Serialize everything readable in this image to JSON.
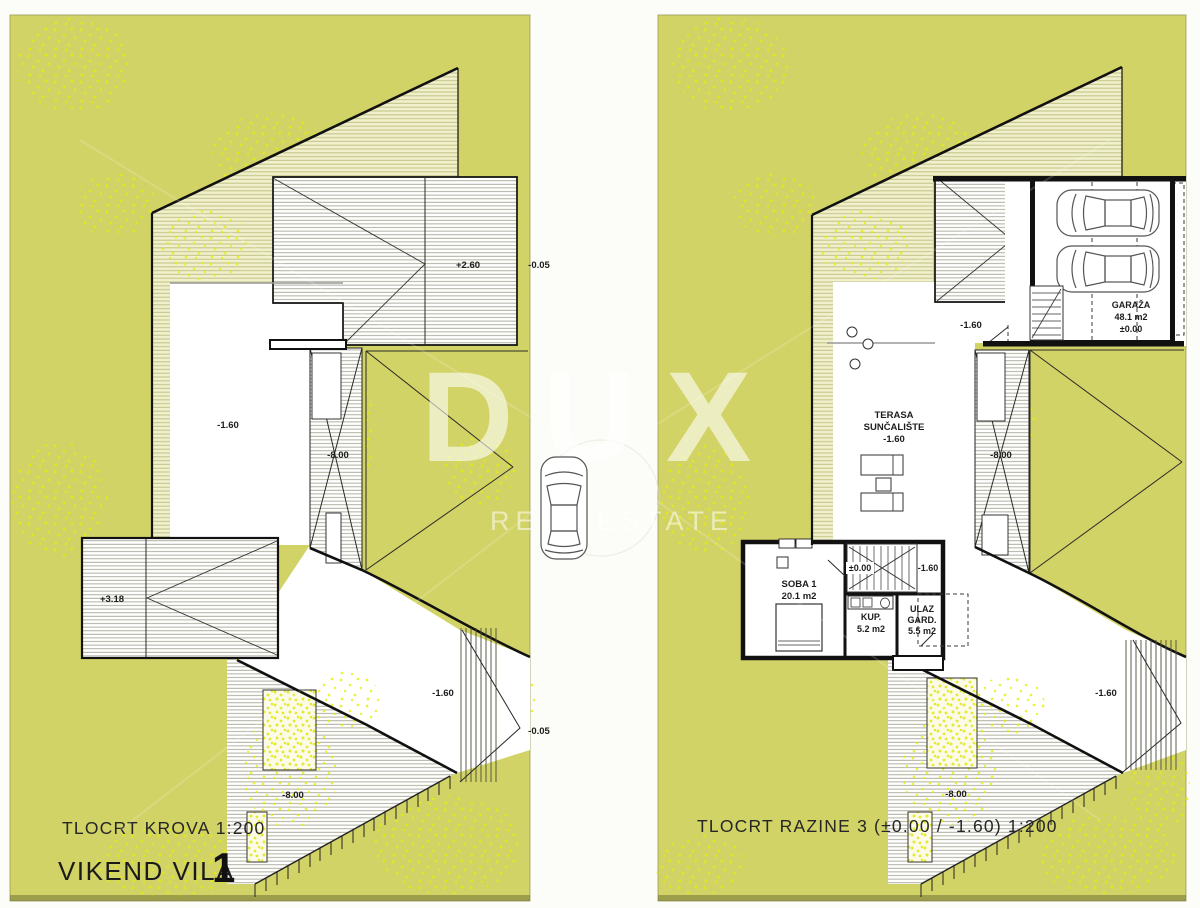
{
  "watermark": {
    "brand": "DUX",
    "tagline": "REAL ESTATE"
  },
  "left_plan": {
    "caption": "TLOCRT KROVA 1:200",
    "project_title": "VIKEND VILA",
    "project_number": "1",
    "levels": {
      "roof_main": "+2.60",
      "plot_ne": "-0.05",
      "terrace": "-1.60",
      "lightwell": "-8.00",
      "roof_lower": "+3.18",
      "driveway": "-1.60",
      "plot_se": "-0.05",
      "slope": "-8.00"
    }
  },
  "right_plan": {
    "caption": "TLOCRT RAZINE 3 (±0.00 / -1.60) 1:200",
    "levels": {
      "outside_garage": "-1.60",
      "lightwell": "-8.00",
      "stair_upper": "±0.00",
      "stair_lower": "-1.60",
      "driveway": "-1.60",
      "slope": "-8.00"
    },
    "rooms": {
      "garage": {
        "name": "GARAŽA",
        "area": "48.1 m2",
        "level": "±0.00"
      },
      "terrace": {
        "name_line1": "TERASA",
        "name_line2": "SUNČALIŠTE",
        "level": "-1.60"
      },
      "bedroom": {
        "name": "SOBA 1",
        "area": "20.1 m2"
      },
      "bathroom": {
        "name": "KUP.",
        "area": "5.2 m2"
      },
      "entry": {
        "name_line1": "ULAZ",
        "name_line2": "GARD.",
        "area": "5.5 m2"
      }
    }
  },
  "colors": {
    "site_green": "#d2d366",
    "speckle_yellow": "#e4ef00",
    "line_black": "#1c1c1c",
    "watermark_white": "rgba(255,255,255,0.6)"
  }
}
